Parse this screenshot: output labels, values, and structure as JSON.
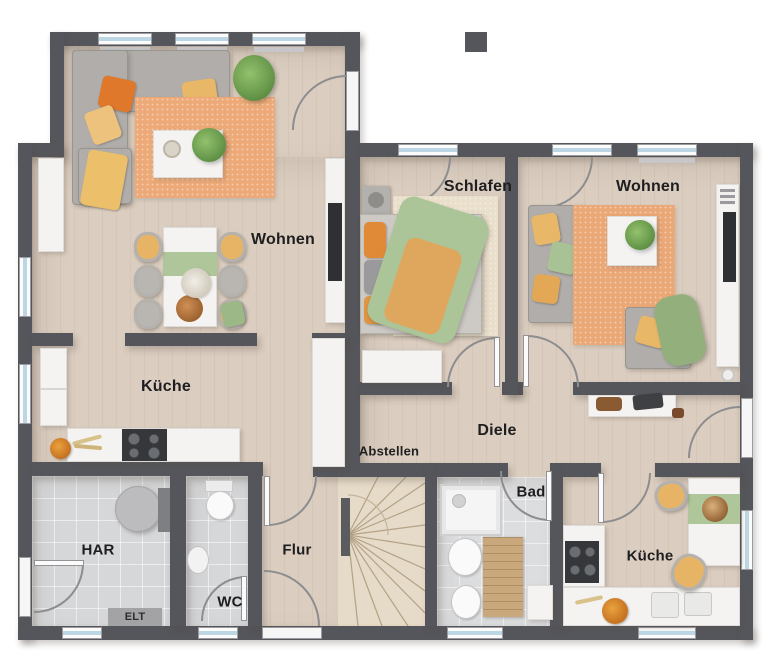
{
  "plan": {
    "type": "floorplan",
    "rooms": [
      {
        "id": "wohnen-left",
        "label": "Wohnen"
      },
      {
        "id": "schlafen",
        "label": "Schlafen"
      },
      {
        "id": "wohnen-right",
        "label": "Wohnen"
      },
      {
        "id": "kueche-left",
        "label": "Küche"
      },
      {
        "id": "diele",
        "label": "Diele"
      },
      {
        "id": "abstellen",
        "label": "Abstellen"
      },
      {
        "id": "bad",
        "label": "Bad"
      },
      {
        "id": "flur",
        "label": "Flur"
      },
      {
        "id": "wc",
        "label": "WC"
      },
      {
        "id": "har",
        "label": "HAR"
      },
      {
        "id": "elt",
        "label": "ELT"
      },
      {
        "id": "kueche-right",
        "label": "Küche"
      }
    ],
    "colors": {
      "wall": "#55565b",
      "wood_floor": "#dbcec0",
      "tile_floor": "#d6d7d9",
      "rug_orange": "#edaa78",
      "accent_yellow": "#e7b466",
      "accent_orange": "#e0782b",
      "accent_green": "#a9c295",
      "window_glass": "#bcd6e4",
      "white_furniture": "#f4f3f1"
    }
  }
}
